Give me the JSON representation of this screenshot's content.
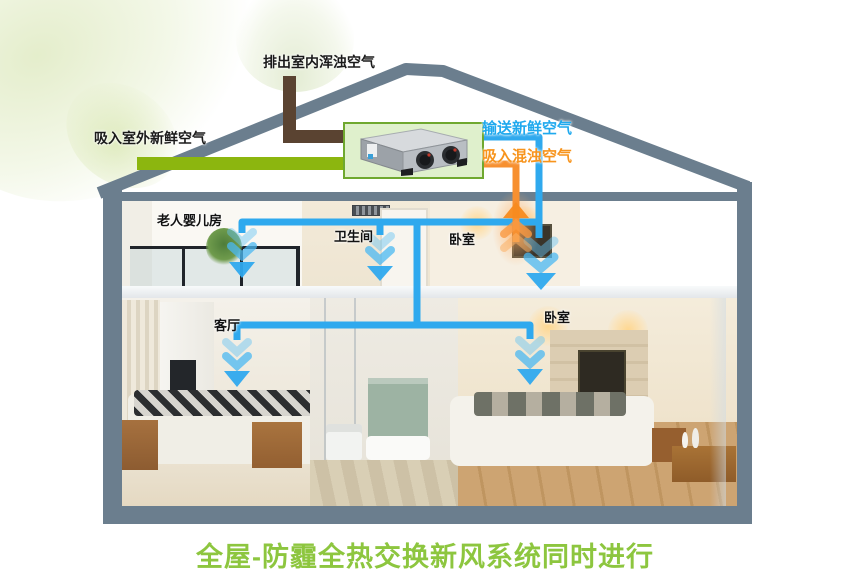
{
  "page": {
    "background": "#ffffff"
  },
  "title": {
    "text": "全屋-防霾全热交换新风系统同时进行",
    "color": "#8DC63F"
  },
  "flow_labels": {
    "exhaust_out": {
      "text": "排出室内浑浊空气",
      "color": "#1A1A1A"
    },
    "fresh_in": {
      "text": "吸入室外新鲜空气",
      "color": "#1A1A1A"
    },
    "supply_fresh": {
      "text": "输送新鲜空气",
      "color": "#1FA9EE"
    },
    "return_stale": {
      "text": "吸入混浊空气",
      "color": "#F7941D"
    }
  },
  "room_labels": [
    {
      "id": "elderly-baby-room",
      "text": "老人婴儿房"
    },
    {
      "id": "bathroom",
      "text": "卫生间"
    },
    {
      "id": "bedroom-upper",
      "text": "卧室"
    },
    {
      "id": "living-room",
      "text": "客厅"
    },
    {
      "id": "bedroom-lower",
      "text": "卧室"
    }
  ],
  "icons": {
    "ventilator_unit": "hrv-unit-with-two-fans",
    "airflow_arrow_down": "blue-chevron-down",
    "airflow_arrow_up": "orange-chevron-up",
    "fresh_air_plume": "pale-green-air-swoosh"
  },
  "colors": {
    "structure_gray": "#6B7E8E",
    "fresh_air_green": "#8CB60F",
    "exhaust_brown": "#5A4331",
    "supply_blue": "#2FA9EE",
    "return_orange": "#F79030",
    "unit_box_fill": "#DFF0CC",
    "unit_box_border": "#6FA82F",
    "title_green": "#8DC63F"
  }
}
